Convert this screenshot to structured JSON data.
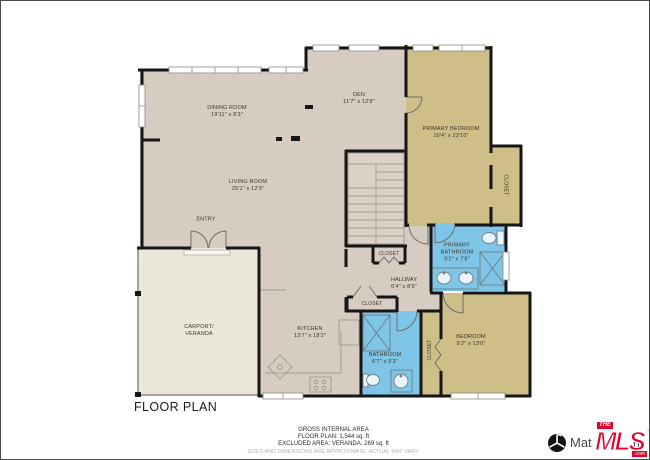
{
  "plan": {
    "title": "FLOOR PLAN",
    "rooms": {
      "dining": {
        "name": "DINING ROOM",
        "dims": "19'11\" x 8'3\""
      },
      "den": {
        "name": "DEN",
        "dims": "11'7\" x 12'8\""
      },
      "primary_bedroom": {
        "name": "PRIMARY BEDROOM",
        "dims": "10'4\" x 23'10\""
      },
      "living": {
        "name": "LIVING ROOM",
        "dims": "25'1\" x 12'9\""
      },
      "entry": {
        "name": "ENTRY"
      },
      "carport": {
        "name": "CARPORT/ VERANDA"
      },
      "kitchen": {
        "name": "KITCHEN",
        "dims": "13'7\" x 18'2\""
      },
      "hallway": {
        "name": "HALLWAY",
        "dims": "6'4\" x 8'9\""
      },
      "primary_bathroom": {
        "name": "PRIMARY BATHROOM",
        "dims": "9'2\" x 7'8\""
      },
      "bathroom": {
        "name": "BATHROOM",
        "dims": "6'7\" x 9'3\""
      },
      "bedroom": {
        "name": "BEDROOM",
        "dims": "9'2\" x 13'0\""
      },
      "closet_primary": {
        "name": "CLOSET"
      },
      "closet_hall_top": {
        "name": "CLOSET"
      },
      "closet_hall_bottom": {
        "name": "CLOSET"
      },
      "closet_bedroom": {
        "name": "CLOSET"
      }
    },
    "footer": {
      "area_heading": "GROSS INTERNAL AREA",
      "area_line1": "FLOOR PLAN: 1,544 sq. ft",
      "area_line2": "EXCLUDED AREA: VERANDA: 269 sq. ft",
      "disclaimer": "SIZES AND DIMENSIONS ARE APPROXIMATE, ACTUAL MAY VARY."
    }
  },
  "branding": {
    "matterport_prefix": "Mat",
    "matterport_suffix": "rt",
    "mls_the": "THE",
    "mls_main": "MLS",
    "mls_com": ".com",
    "mls_tm": "™"
  },
  "colors": {
    "floor_main": "#d6ccc2",
    "floor_bedroom": "#cdbf87",
    "floor_bathroom": "#7fc5e8",
    "floor_carport": "#ebe7da",
    "wall": "#161616",
    "mls_red": "#e4002b"
  }
}
